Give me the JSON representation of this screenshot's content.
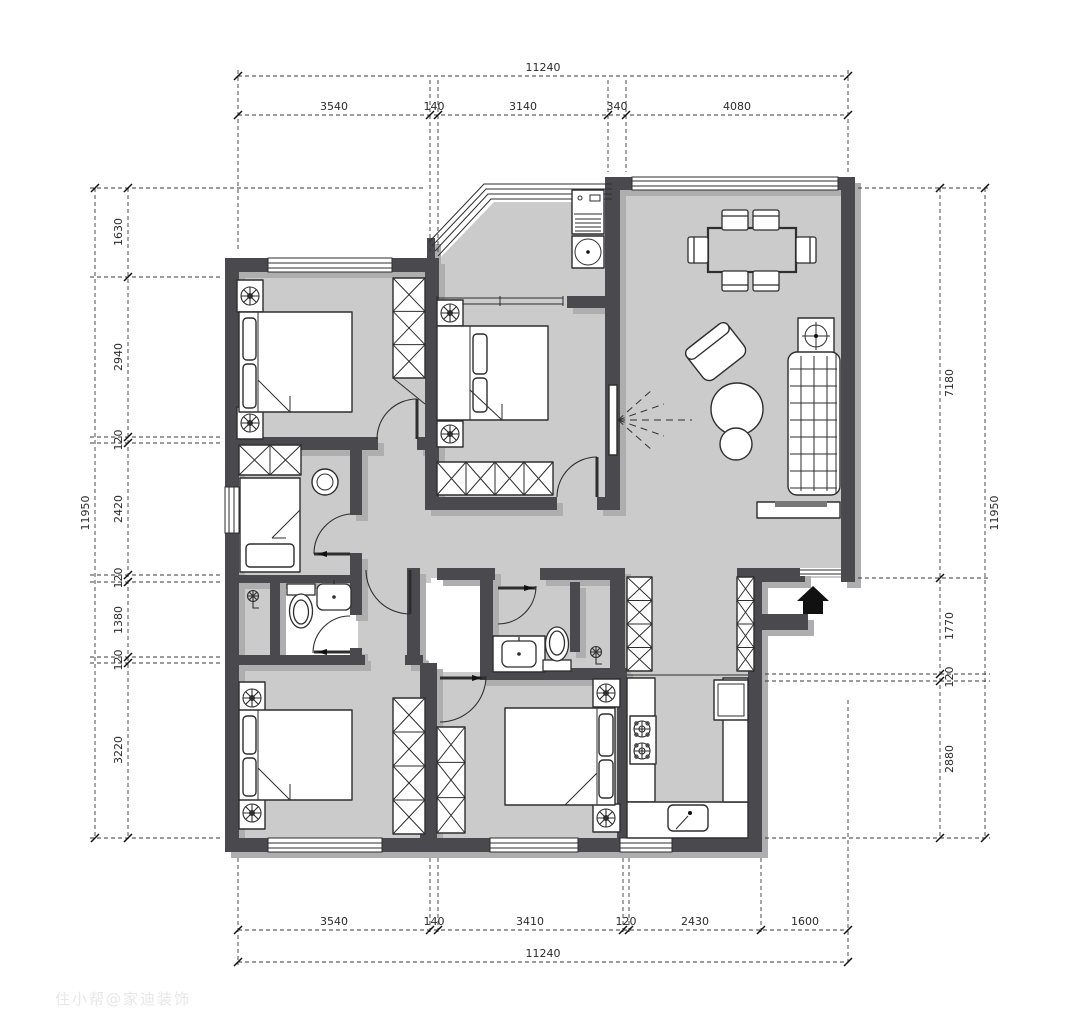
{
  "watermark": "住小帮@家迪装饰",
  "colors": {
    "wall": "#4a4a4e",
    "wall_shadow": "#aeaeae",
    "floor": "#cbcbcb",
    "furniture_line": "#2e2e2e",
    "dimension": "#2b2b2b",
    "watermark": "#e7e7e7"
  },
  "dims": {
    "top": {
      "total": "11240",
      "segments": [
        "3540",
        "140",
        "3140",
        "340",
        "4080"
      ]
    },
    "bottom": {
      "total": "11240",
      "segments": [
        "3540",
        "140",
        "3410",
        "120",
        "2430",
        "1600"
      ]
    },
    "left": {
      "total": "11950",
      "segments": [
        "1630",
        "2940",
        "120",
        "2420",
        "120",
        "1380",
        "120",
        "3220"
      ]
    },
    "right": {
      "total": "11950",
      "segments": [
        "7180",
        "1770",
        "120",
        "2880"
      ]
    }
  }
}
